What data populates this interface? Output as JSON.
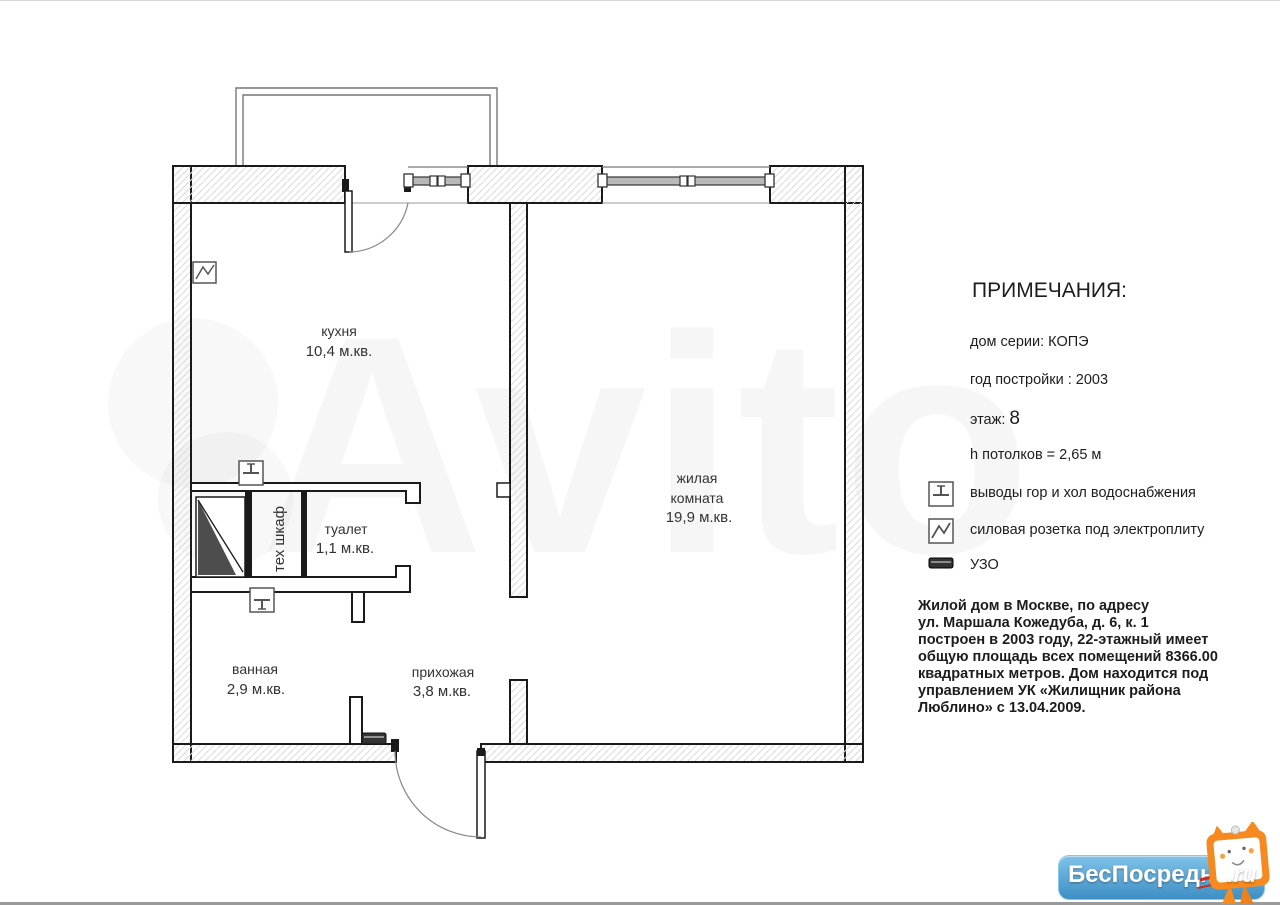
{
  "plan": {
    "rooms": {
      "kitchen": {
        "name": "кухня",
        "area": "10,4 м.кв."
      },
      "living": {
        "line1": "жилая",
        "line2": "комната",
        "area": "19,9 м.кв."
      },
      "toilet": {
        "name": "туалет",
        "area": "1,1 м.кв."
      },
      "bath": {
        "name": "ванная",
        "area": "2,9 м.кв."
      },
      "hall": {
        "name": "прихожая",
        "area": "3,8 м.кв."
      },
      "techcab": {
        "name": "тех шкаф"
      }
    }
  },
  "notes": {
    "title": "ПРИМЕЧАНИЯ:",
    "series": "дом серии: КОПЭ",
    "year": "год постройки : 2003",
    "floor_label": "этаж:",
    "floor_value": "8",
    "ceiling": "h потолков = 2,65 м",
    "legend": [
      {
        "icon": "water-outlets-icon",
        "label": "выводы гор и хол водоснабжения"
      },
      {
        "icon": "power-socket-icon",
        "label": "силовая розетка под электроплиту"
      },
      {
        "icon": "rcd-icon",
        "label": "УЗО"
      }
    ],
    "description_lines": [
      "Жилой дом в Москве,  по адресу",
      "ул. Маршала Кожедуба, д. 6, к. 1",
      "построен в 2003 году, 22-этажный имеет",
      "общую площадь всех помещений 8366.00",
      "квадратных метров. Дом находится под",
      "управлением УК «Жилищник района",
      "Люблино» с 13.04.2009."
    ]
  },
  "watermark": {
    "text": "Avito"
  },
  "logo": {
    "text": "БесПосредника",
    "suffix": ".ru"
  },
  "colors": {
    "wall_line": "#1a1a1a",
    "hatch": "#dcdcdc",
    "window_bar": "#b8b8b8",
    "dark_fill": "#4d4d4d",
    "logo_blue": "#4596cb",
    "mascot_orange": "#f6891f"
  }
}
